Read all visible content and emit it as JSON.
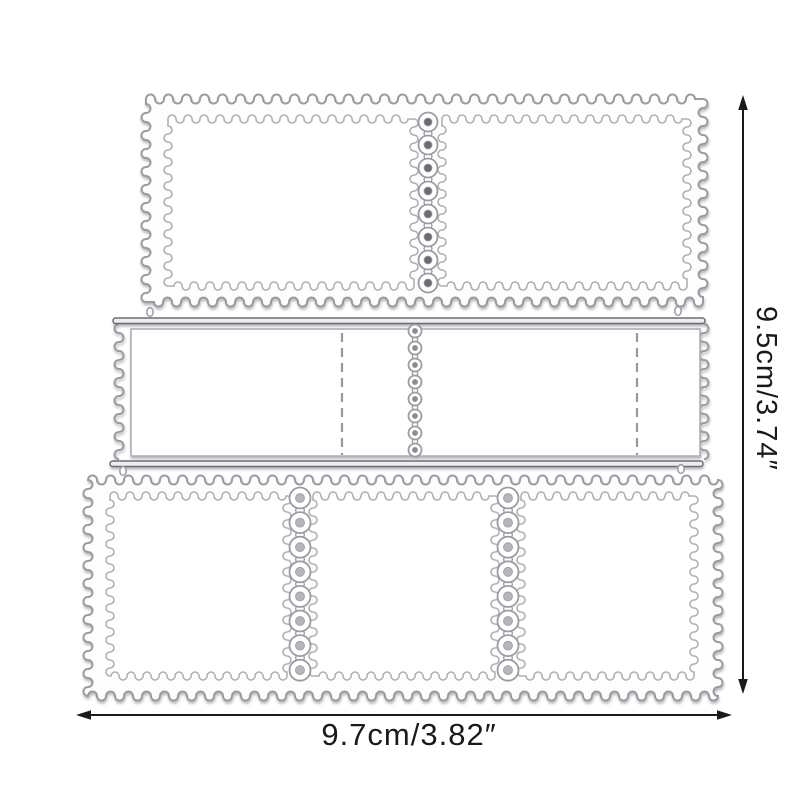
{
  "scene": {
    "background_color": "#ffffff",
    "die_outline_color": "#9d9aa2",
    "die_inner_outline_color": "#b1aeb5",
    "die_bar_outline_color": "#6f6c74",
    "die_bar_fill_color": "#eeedf0",
    "die_fill_color": "#fdfdfe",
    "opening_fill_color": "#ffffff",
    "dash_line_color": "#9a97a0",
    "hole_fill_top": "#6e6a73",
    "hole_fill_middle": "#8d8a92",
    "hole_fill_bottom": "#b7b4bb",
    "shadow_color": "#77747e",
    "annotation_color": "#1a1a1a"
  },
  "annotations": {
    "height_label": "9.5cm/3.74″",
    "width_label": "9.7cm/3.82″"
  }
}
